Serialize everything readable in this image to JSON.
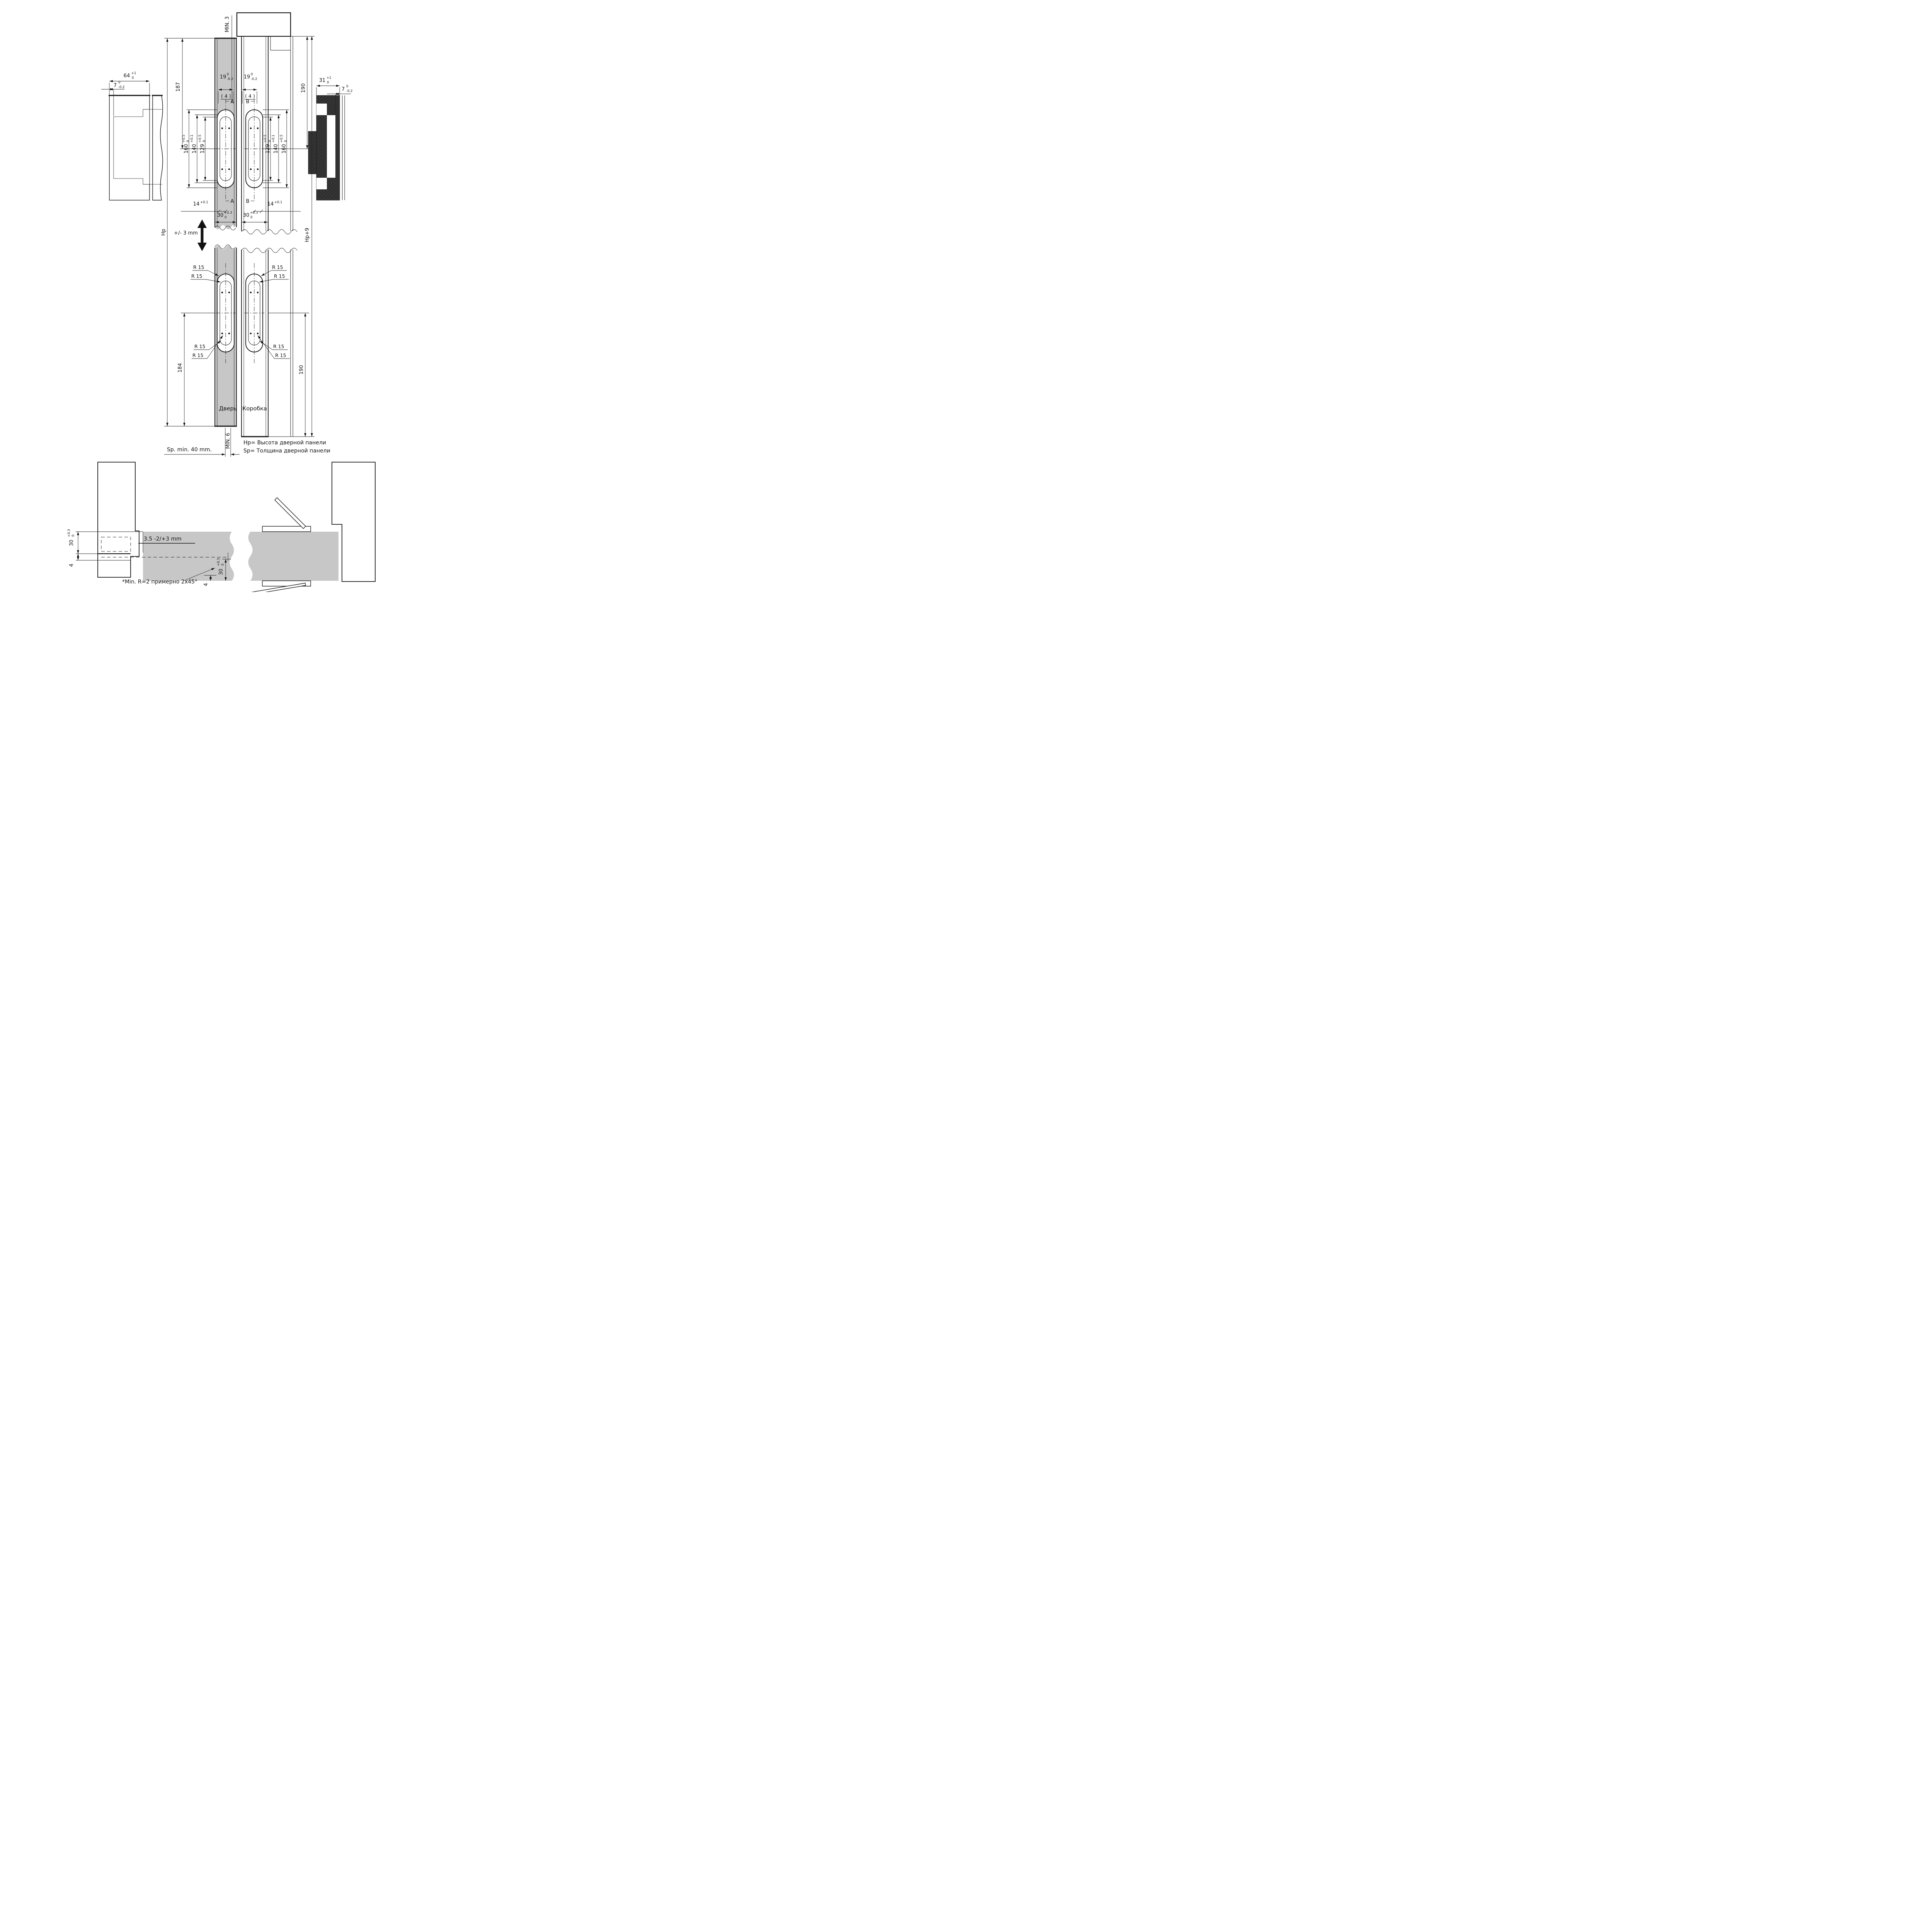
{
  "drawing": {
    "type": "technical-installation-drawing",
    "subject": "concealed door hinge mortise dimensions",
    "colors": {
      "door_fill": "#c7c7c7",
      "line": "#161616",
      "dark_section": "#2e2e2e",
      "background": "#ffffff"
    }
  },
  "labels": {
    "min3": "MIN. 3",
    "min6": "MIN. 6",
    "hp": "Hp",
    "hp_plus9": "Hp+9",
    "plus_minus_3mm": "+/- 3 mm",
    "r15": "R 15",
    "section_a": "A",
    "section_b": "B",
    "qty4": "( 4 )",
    "d187": "187",
    "d190": "190",
    "d184": "184",
    "door": "Дверь",
    "frame": "Коробка",
    "sp_min": "Sp. min. 40 mm.",
    "note_hp": "Hp= Высота дверной панели",
    "note_sp": "Sp= Толщина дверной панели",
    "note_r": "*Min. R=2 примерно 2x45°",
    "gap": "3.5 -2/+3 mm",
    "d4": "4"
  },
  "tol_dims": {
    "d64": {
      "v": "64",
      "sup": "+1",
      "sub": "0"
    },
    "d31": {
      "v": "31",
      "sup": "+1",
      "sub": "0"
    },
    "d7": {
      "v": "7",
      "sup": "0",
      "sub": "-0.2"
    },
    "d19": {
      "v": "19",
      "sup": "0",
      "sub": "-0.2"
    },
    "d160": {
      "v": "160",
      "sup": "+0.5",
      "sub": "0"
    },
    "d140": {
      "v": "140",
      "sup": "+0.1",
      "sub": ""
    },
    "d129": {
      "v": "129",
      "sup": "+0.5",
      "sub": "0"
    },
    "d14": {
      "v": "14",
      "sup": "+0.1",
      "sub": ""
    },
    "d30": {
      "v": "30",
      "sup": "+0.3",
      "sub": "0"
    }
  }
}
